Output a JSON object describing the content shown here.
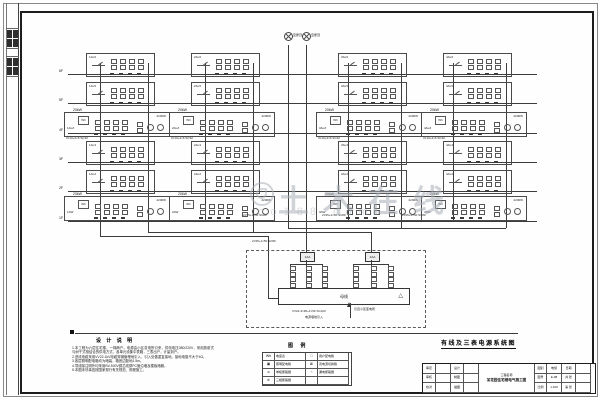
{
  "sheet": {
    "floors": [
      "6F",
      "5F",
      "4F",
      "3F",
      "2F",
      "1F"
    ],
    "figtitle": "有线及三表电源系统图"
  },
  "watermark": {
    "text": "土木在线",
    "sub": "co188.com"
  },
  "roof": {
    "label1": "至屋顶",
    "label2": "至屋顶"
  },
  "boxes": {
    "narrow_labels": [
      [
        "1AL6",
        "2AL6",
        "3AL6",
        "4AL6"
      ],
      [
        "1AL5",
        "2AL5",
        "3AL5",
        "4AL5"
      ],
      [
        "1AL3",
        "2AL3",
        "3AL3",
        "4AL3"
      ],
      [
        "1AL2",
        "2AL2",
        "3AL2",
        "4AL2"
      ]
    ],
    "wide_labels": [
      [
        "1ALZ",
        "2ALZ",
        "3ALZ",
        "4ALZ"
      ],
      [
        "1AW",
        "2AW",
        "3AW",
        "4AW"
      ]
    ],
    "wide_outside": "20kW",
    "wide_rating": "2200W",
    "meter": "Wh",
    "branch_spec": "3×10+2×6 SC32"
  },
  "feeders": {
    "spec": "2×95+1×50 SC80"
  },
  "panel": {
    "head1": "1AA",
    "head2": "2AA",
    "bus_label": "母线",
    "tri": "△",
    "incoming_spec": "VV22-4×95+1×50 SC100",
    "incoming_note": "电源埋地引入",
    "source_note": "引自小区变电所"
  },
  "notes": {
    "title": "设 计 说 明",
    "lines": [
      "1.本工程为六层住宅楼，一梯两户。电源由小区变电所引来，供电电压380/220V，采用放射式与树干式相结合的供电方式，各单元设集中表箱，三表出户，计量到户。",
      "2.进线电缆采用VV22-1kV电缆穿钢管埋地引入，引入处做重复接地，接地电阻不大于4Ω。",
      "3.各层照明配电箱均为暗装，箱底边距地1.5m。",
      "4.导线除注明外均采用BV-500V铜芯线穿PC管沿墙及楼板暗敷。",
      "5.本图未尽事宜按国家现行有关规范、规程施工。"
    ]
  },
  "legend": {
    "title": "图 例",
    "rows": [
      {
        "s1": "Wh",
        "n1": "电度表",
        "s2": "□",
        "n2": "用户配电箱"
      },
      {
        "s1": "▣",
        "n1": "照明配电箱",
        "s2": "⊠",
        "n2": "双电源切换箱"
      },
      {
        "s1": "⌀",
        "n1": "单极断路器",
        "s2": "⌁",
        "n2": "漏电断路器"
      },
      {
        "s1": "⊘",
        "n1": "三相断路器",
        "s2": "",
        "n2": ""
      }
    ]
  },
  "titleblock": {
    "l1": "审定",
    "l2": "审核",
    "l3": "校对",
    "m1": "设计",
    "m2": "制图",
    "m3": "描图",
    "project_label": "工程名称",
    "project": "某花园住宅楼电气施工图",
    "c1a": "图别",
    "c1b": "电施",
    "c2a": "图号",
    "c2b": "E-08",
    "c3a": "比例",
    "c3b": "1:100",
    "d1": "日期",
    "d2": "共 张",
    "d3": "第 张"
  }
}
